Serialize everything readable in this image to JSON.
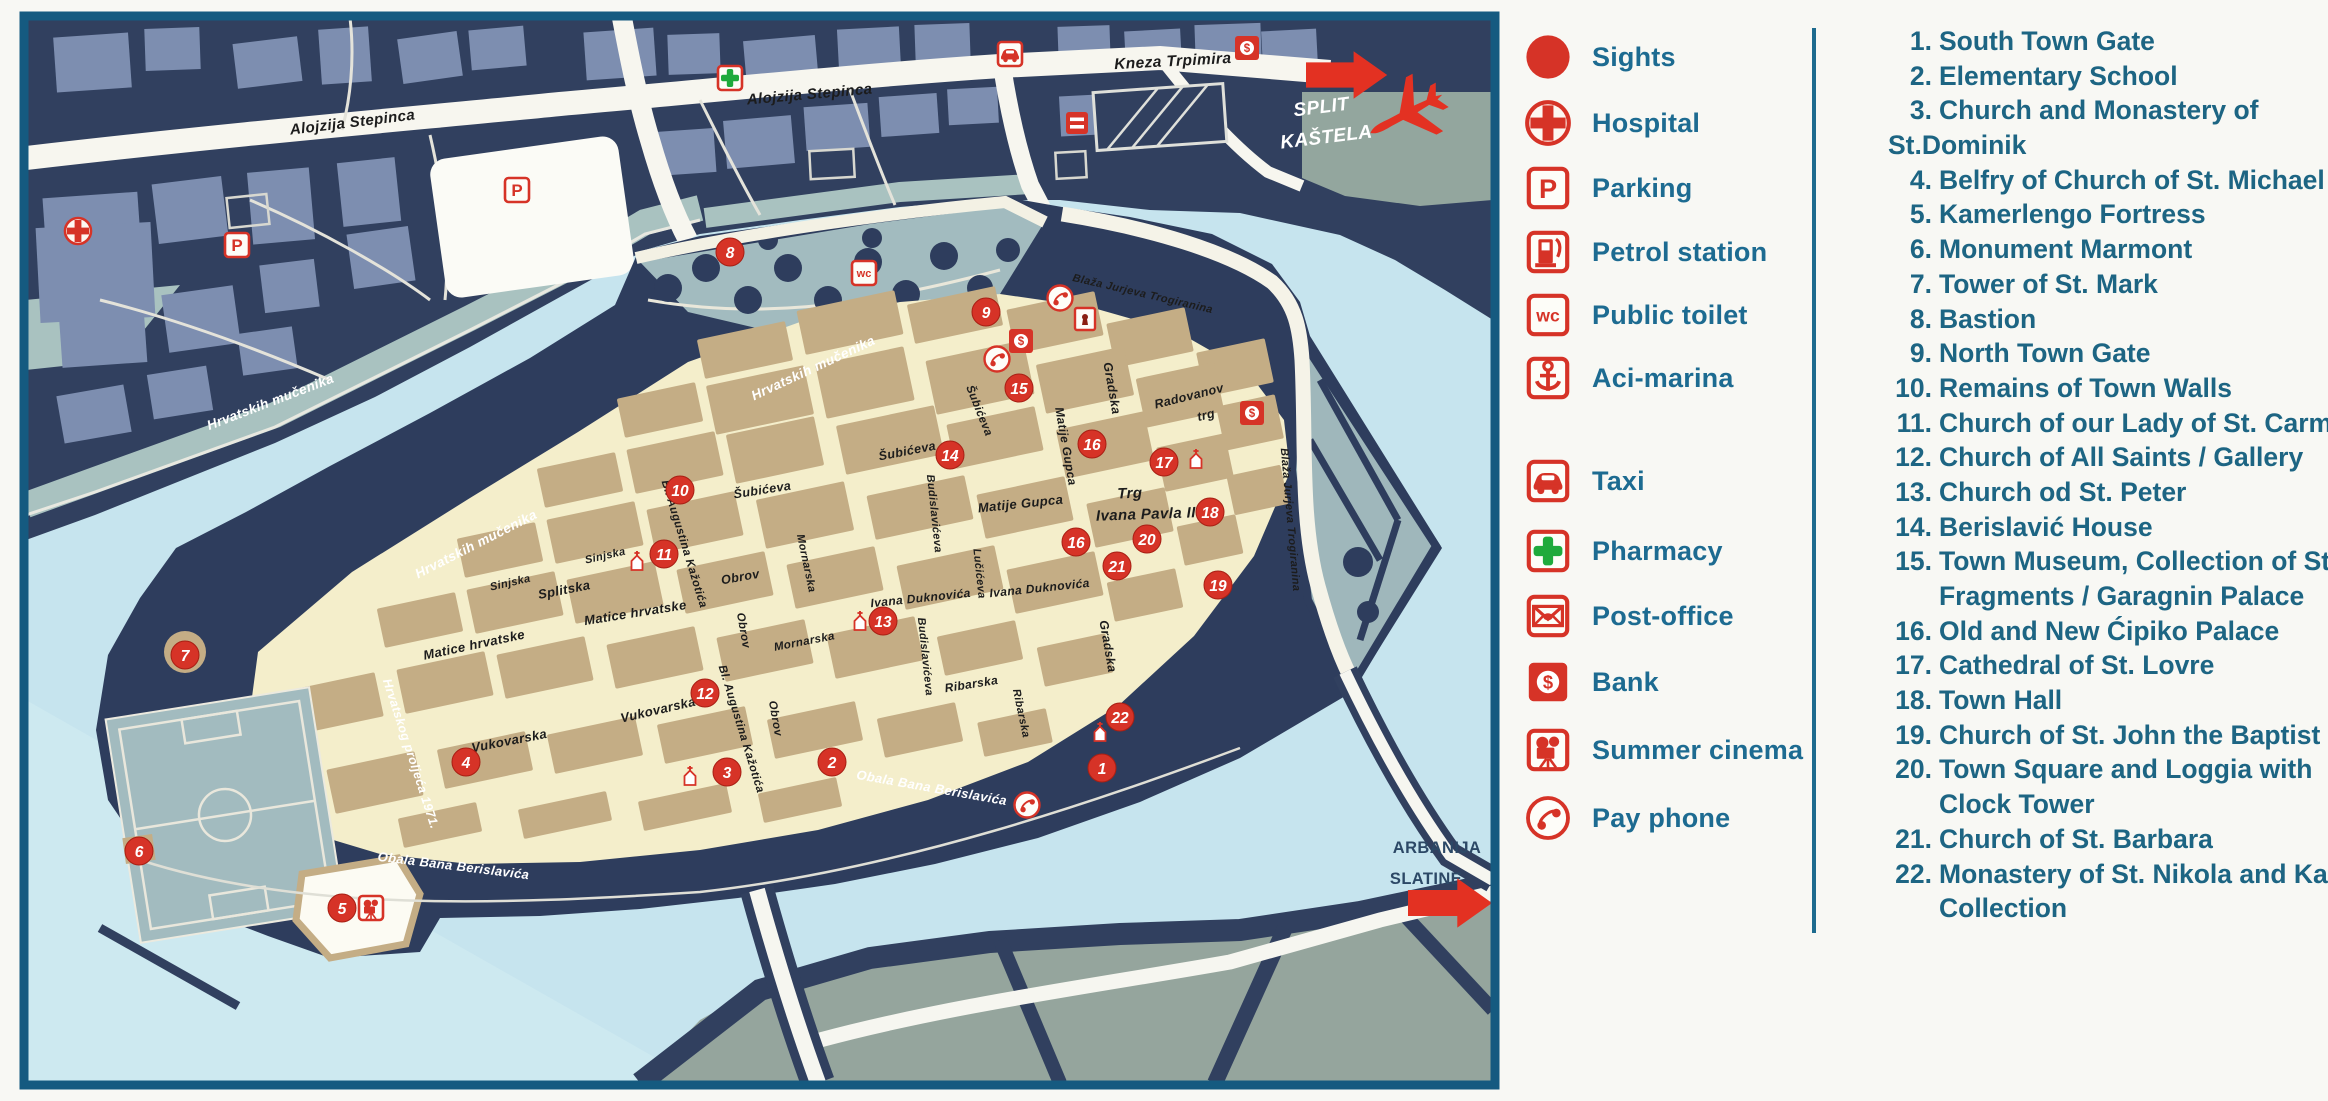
{
  "palette": {
    "water": "#c6e4ee",
    "mainland": "#31405f",
    "building_light": "#7d8eb0",
    "old_town": "#f4eecb",
    "town_building": "#c4ad85",
    "park": "#a2bbbf",
    "ciovo": "#95a59d",
    "road_white": "#f7f6ef",
    "marker_red": "#d63327",
    "arrow_red": "#e33122",
    "pharmacy_green": "#1faa3c",
    "legend_text": "#1d6b91",
    "list_text": "#1d6583",
    "frame_blue": "#155a80"
  },
  "legend": {
    "items": [
      {
        "icon": "sights",
        "label": "Sights",
        "y": 57
      },
      {
        "icon": "hospital",
        "label": "Hospital",
        "y": 123
      },
      {
        "icon": "parking",
        "label": "Parking",
        "y": 188
      },
      {
        "icon": "petrol",
        "label": "Petrol station",
        "y": 252
      },
      {
        "icon": "wc",
        "label": "Public toilet",
        "y": 315
      },
      {
        "icon": "marina",
        "label": "Aci-marina",
        "y": 378
      },
      {
        "icon": "taxi",
        "label": "Taxi",
        "y": 481
      },
      {
        "icon": "pharmacy",
        "label": "Pharmacy",
        "y": 551
      },
      {
        "icon": "post",
        "label": "Post-office",
        "y": 616
      },
      {
        "icon": "bank",
        "label": "Bank",
        "y": 682
      },
      {
        "icon": "cinema",
        "label": "Summer cinema",
        "y": 750
      },
      {
        "icon": "phone",
        "label": "Pay phone",
        "y": 818
      }
    ]
  },
  "sights_list": {
    "lines": [
      {
        "num": "1.",
        "text": "South Town Gate",
        "indent": "num"
      },
      {
        "num": "2.",
        "text": "Elementary School",
        "indent": "num"
      },
      {
        "num": "3.",
        "text": "Church and Monastery of",
        "indent": "num"
      },
      {
        "num": "",
        "text": "St.Dominik",
        "indent": "flush"
      },
      {
        "num": "4.",
        "text": "Belfry of Church of St. Michael",
        "indent": "num"
      },
      {
        "num": "5.",
        "text": "Kamerlengo Fortress",
        "indent": "num"
      },
      {
        "num": "6.",
        "text": "Monument Marmont",
        "indent": "num"
      },
      {
        "num": "7.",
        "text": "Tower of St. Mark",
        "indent": "num"
      },
      {
        "num": "8.",
        "text": "Bastion",
        "indent": "num"
      },
      {
        "num": "9.",
        "text": "North Town Gate",
        "indent": "num"
      },
      {
        "num": "10.",
        "text": "Remains of Town Walls",
        "indent": "num"
      },
      {
        "num": "11.",
        "text": "Church of our Lady of St. Carmel",
        "indent": "num"
      },
      {
        "num": "12.",
        "text": "Church of All Saints / Gallery",
        "indent": "num"
      },
      {
        "num": "13.",
        "text": "Church od St. Peter",
        "indent": "num"
      },
      {
        "num": "14.",
        "text": "Berislavić House",
        "indent": "num"
      },
      {
        "num": "15.",
        "text": "Town Museum, Collection of Stone",
        "indent": "num"
      },
      {
        "num": "",
        "text": "Fragments / Garagnin Palace",
        "indent": "cont"
      },
      {
        "num": "16.",
        "text": "Old and New Ćipiko Palace",
        "indent": "num"
      },
      {
        "num": "17.",
        "text": "Cathedral of St. Lovre",
        "indent": "num"
      },
      {
        "num": "18.",
        "text": "Town Hall",
        "indent": "num"
      },
      {
        "num": "19.",
        "text": "Church of St. John the Baptist",
        "indent": "num"
      },
      {
        "num": "20.",
        "text": "Town Square and Loggia with",
        "indent": "num"
      },
      {
        "num": "",
        "text": "Clock Tower",
        "indent": "cont"
      },
      {
        "num": "21.",
        "text": "Church of St. Barbara",
        "indent": "num"
      },
      {
        "num": "22.",
        "text": "Monastery of St. Nikola and Kairos",
        "indent": "num"
      },
      {
        "num": "",
        "text": "Collection",
        "indent": "cont"
      }
    ]
  },
  "map": {
    "street_labels": [
      {
        "text": "Alojzija Stepinca",
        "x": 353,
        "y": 127,
        "rot": -7,
        "size": 15,
        "cls": "dark"
      },
      {
        "text": "Alojzija Stepinca",
        "x": 810,
        "y": 99,
        "rot": -5,
        "size": 15,
        "cls": "dark"
      },
      {
        "text": "Kneza Trpimira",
        "x": 1173,
        "y": 66,
        "rot": -3,
        "size": 15.5,
        "cls": "dark"
      },
      {
        "text": "Sinjska",
        "x": 511,
        "y": 586,
        "rot": -13,
        "size": 11,
        "cls": "dark"
      },
      {
        "text": "Sinjska",
        "x": 606,
        "y": 559,
        "rot": -13,
        "size": 11,
        "cls": "dark"
      },
      {
        "text": "Splitska",
        "x": 565,
        "y": 594,
        "rot": -11,
        "size": 13,
        "cls": "dark"
      },
      {
        "text": "Matice hrvatske",
        "x": 475,
        "y": 649,
        "rot": -12,
        "size": 13,
        "cls": "dark"
      },
      {
        "text": "Matice hrvatske",
        "x": 636,
        "y": 617,
        "rot": -9,
        "size": 13,
        "cls": "dark"
      },
      {
        "text": "Vukovarska",
        "x": 510,
        "y": 745,
        "rot": -11,
        "size": 13,
        "cls": "dark"
      },
      {
        "text": "Vukovarska",
        "x": 659,
        "y": 714,
        "rot": -13,
        "size": 13,
        "cls": "dark"
      },
      {
        "text": "Bl. Augustina Kažotića",
        "x": 681,
        "y": 545,
        "rot": 73,
        "size": 11.5,
        "cls": "dark"
      },
      {
        "text": "Bl. Augustina Kažotića",
        "x": 738,
        "y": 730,
        "rot": 73,
        "size": 11.5,
        "cls": "dark"
      },
      {
        "text": "Obrov",
        "x": 741,
        "y": 581,
        "rot": -10,
        "size": 12.5,
        "cls": "dark"
      },
      {
        "text": "Obrov",
        "x": 740,
        "y": 631,
        "rot": 80,
        "size": 11.5,
        "cls": "dark"
      },
      {
        "text": "Obrov",
        "x": 772,
        "y": 719,
        "rot": 80,
        "size": 11.5,
        "cls": "dark"
      },
      {
        "text": "Šubićeva",
        "x": 763,
        "y": 494,
        "rot": -9,
        "size": 12.5,
        "cls": "dark"
      },
      {
        "text": "Šubićeva",
        "x": 908,
        "y": 455,
        "rot": -11,
        "size": 12.5,
        "cls": "dark"
      },
      {
        "text": "Šubićeva",
        "x": 976,
        "y": 412,
        "rot": 68,
        "size": 11.5,
        "cls": "dark"
      },
      {
        "text": "Budislavićeva",
        "x": 931,
        "y": 514,
        "rot": 84,
        "size": 11,
        "cls": "dark"
      },
      {
        "text": "Budislavićeva",
        "x": 922,
        "y": 657,
        "rot": 84,
        "size": 11,
        "cls": "dark"
      },
      {
        "text": "Mornarska",
        "x": 803,
        "y": 564,
        "rot": 78,
        "size": 11,
        "cls": "dark"
      },
      {
        "text": "Mornarska",
        "x": 805,
        "y": 645,
        "rot": -11,
        "size": 11.5,
        "cls": "dark"
      },
      {
        "text": "Lučićeva",
        "x": 976,
        "y": 574,
        "rot": 84,
        "size": 11,
        "cls": "dark"
      },
      {
        "text": "Ivana Duknovića",
        "x": 921,
        "y": 602,
        "rot": -6,
        "size": 12,
        "cls": "dark"
      },
      {
        "text": "Ivana Duknovića",
        "x": 1040,
        "y": 592,
        "rot": -6,
        "size": 12,
        "cls": "dark"
      },
      {
        "text": "Ribarska",
        "x": 972,
        "y": 688,
        "rot": -9,
        "size": 12,
        "cls": "dark"
      },
      {
        "text": "Ribarska",
        "x": 1018,
        "y": 714,
        "rot": 78,
        "size": 11,
        "cls": "dark"
      },
      {
        "text": "Gradska",
        "x": 1108,
        "y": 389,
        "rot": 80,
        "size": 12.5,
        "cls": "dark"
      },
      {
        "text": "Gradska",
        "x": 1104,
        "y": 647,
        "rot": 80,
        "size": 12.5,
        "cls": "dark"
      },
      {
        "text": "Matije Gupca",
        "x": 1062,
        "y": 447,
        "rot": 80,
        "size": 12,
        "cls": "dark"
      },
      {
        "text": "Matije Gupca",
        "x": 1021,
        "y": 508,
        "rot": -6,
        "size": 13,
        "cls": "dark"
      },
      {
        "text": "Radovanov",
        "x": 1190,
        "y": 400,
        "rot": -14,
        "size": 12.5,
        "cls": "dark"
      },
      {
        "text": "trg",
        "x": 1207,
        "y": 419,
        "rot": -14,
        "size": 12.5,
        "cls": "dark"
      },
      {
        "text": "Trg",
        "x": 1130,
        "y": 498,
        "rot": -2,
        "size": 15,
        "cls": "dark"
      },
      {
        "text": "Ivana Pavla II",
        "x": 1146,
        "y": 519,
        "rot": -2,
        "size": 15,
        "cls": "dark"
      },
      {
        "text": "Blaža Jurjeva Trogiranina",
        "x": 1142,
        "y": 297,
        "rot": 13,
        "size": 11,
        "cls": "dark"
      },
      {
        "text": "Blaža Jurjeva Trogiranina",
        "x": 1287,
        "y": 520,
        "rot": 85,
        "size": 11,
        "cls": "dark"
      },
      {
        "text": "Hrvatskih mučenika",
        "x": 272,
        "y": 406,
        "rot": -21,
        "size": 13.5,
        "cls": "white"
      },
      {
        "text": "Hrvatskih mučenika",
        "x": 478,
        "y": 548,
        "rot": -27,
        "size": 13.5,
        "cls": "white"
      },
      {
        "text": "Hrvatskih mučenika",
        "x": 815,
        "y": 372,
        "rot": -25,
        "size": 13.5,
        "cls": "white"
      },
      {
        "text": "Hrvatskog proljeća 1971.",
        "x": 407,
        "y": 755,
        "rot": 72,
        "size": 12.5,
        "cls": "white"
      },
      {
        "text": "Obala Bana Berislavića",
        "x": 931,
        "y": 792,
        "rot": 10,
        "size": 13,
        "cls": "white"
      },
      {
        "text": "Obala Bana Berislavića",
        "x": 453,
        "y": 870,
        "rot": 7,
        "size": 13,
        "cls": "white"
      },
      {
        "text": "SPLIT",
        "x": 1322,
        "y": 113,
        "rot": -7,
        "size": 19,
        "cls": "whitebig"
      },
      {
        "text": "KAŠTELA",
        "x": 1327,
        "y": 143,
        "rot": -7,
        "size": 19,
        "cls": "whitebig"
      },
      {
        "text": "ARBANIJA",
        "x": 1437,
        "y": 853,
        "rot": 0,
        "size": 16.5,
        "cls": "navy"
      },
      {
        "text": "SLATINE",
        "x": 1426,
        "y": 884,
        "rot": 0,
        "size": 16.5,
        "cls": "navy"
      }
    ],
    "markers": [
      {
        "n": "1",
        "x": 1102,
        "y": 768
      },
      {
        "n": "2",
        "x": 832,
        "y": 762
      },
      {
        "n": "3",
        "x": 727,
        "y": 772
      },
      {
        "n": "4",
        "x": 466,
        "y": 762
      },
      {
        "n": "5",
        "x": 342,
        "y": 908
      },
      {
        "n": "6",
        "x": 139,
        "y": 851
      },
      {
        "n": "7",
        "x": 185,
        "y": 655
      },
      {
        "n": "8",
        "x": 730,
        "y": 252
      },
      {
        "n": "9",
        "x": 986,
        "y": 312
      },
      {
        "n": "10",
        "x": 680,
        "y": 490
      },
      {
        "n": "11",
        "x": 664,
        "y": 554
      },
      {
        "n": "12",
        "x": 705,
        "y": 693
      },
      {
        "n": "13",
        "x": 883,
        "y": 621
      },
      {
        "n": "14",
        "x": 950,
        "y": 455
      },
      {
        "n": "15",
        "x": 1019,
        "y": 388
      },
      {
        "n": "16",
        "x": 1092,
        "y": 444
      },
      {
        "n": "16",
        "x": 1076,
        "y": 542
      },
      {
        "n": "17",
        "x": 1164,
        "y": 462
      },
      {
        "n": "18",
        "x": 1210,
        "y": 512
      },
      {
        "n": "19",
        "x": 1218,
        "y": 585
      },
      {
        "n": "20",
        "x": 1147,
        "y": 539
      },
      {
        "n": "21",
        "x": 1117,
        "y": 566
      },
      {
        "n": "22",
        "x": 1120,
        "y": 717
      }
    ],
    "icons": [
      {
        "type": "hospital",
        "x": 78,
        "y": 231
      },
      {
        "type": "parking",
        "x": 237,
        "y": 245
      },
      {
        "type": "parking",
        "x": 517,
        "y": 190
      },
      {
        "type": "pharmacy",
        "x": 730,
        "y": 78
      },
      {
        "type": "taxi",
        "x": 1010,
        "y": 54
      },
      {
        "type": "bank",
        "x": 1247,
        "y": 48
      },
      {
        "type": "roadsign",
        "x": 1077,
        "y": 123
      },
      {
        "type": "wc",
        "x": 864,
        "y": 273
      },
      {
        "type": "gate",
        "x": 1085,
        "y": 319
      },
      {
        "type": "phone",
        "x": 1060,
        "y": 298
      },
      {
        "type": "phone",
        "x": 997,
        "y": 359
      },
      {
        "type": "phone",
        "x": 1027,
        "y": 805
      },
      {
        "type": "bank",
        "x": 1021,
        "y": 341
      },
      {
        "type": "bank",
        "x": 1252,
        "y": 413
      },
      {
        "type": "church",
        "x": 637,
        "y": 562
      },
      {
        "type": "church",
        "x": 690,
        "y": 777
      },
      {
        "type": "church",
        "x": 860,
        "y": 622
      },
      {
        "type": "church",
        "x": 1196,
        "y": 460
      },
      {
        "type": "church",
        "x": 1100,
        "y": 733
      },
      {
        "type": "cinema",
        "x": 371,
        "y": 908
      }
    ],
    "arrows": [
      {
        "x": 1306,
        "y": 75,
        "scale": 1.4
      },
      {
        "x": 1408,
        "y": 903,
        "scale": 1.45
      }
    ],
    "plane": {
      "x": 1408,
      "y": 113,
      "rot": -28,
      "scale": 1.25
    }
  }
}
